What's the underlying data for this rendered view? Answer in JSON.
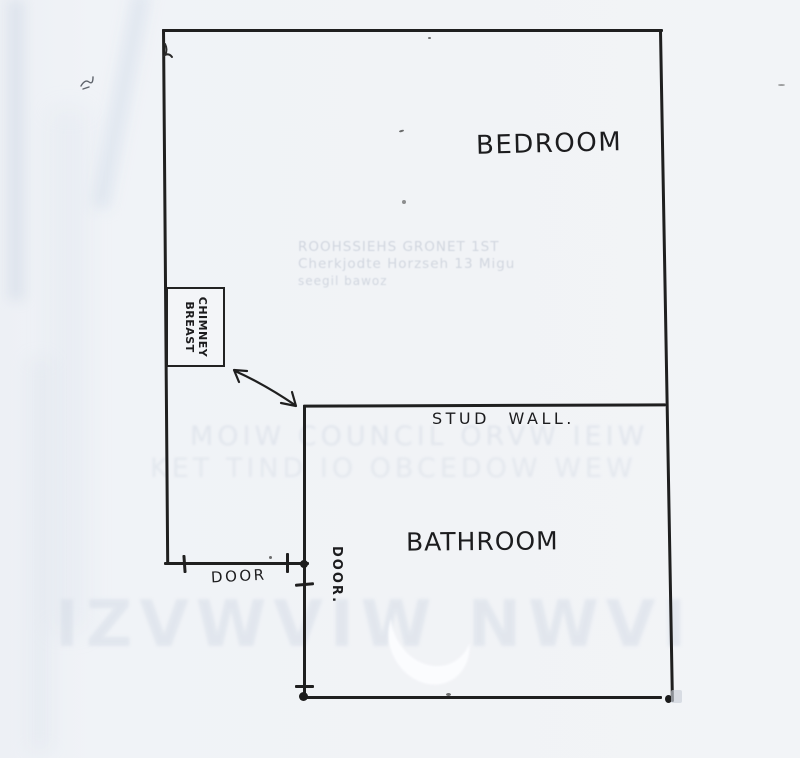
{
  "page": {
    "type": "scanned hand-drawn floor plan",
    "paper_color": "#f1f3f6",
    "ink_color": "#1f1f1f"
  },
  "plan": {
    "labels": {
      "bedroom": "BEDROOM",
      "bathroom": "BATHROOM",
      "stud_wall": "STUD WALL.",
      "chimney_line1": "CHIMNEY",
      "chimney_line2": "BREAST",
      "door_horizontal": "DOOR",
      "door_vertical": "DOOR."
    }
  },
  "bleed_through": {
    "block_a": {
      "line1": "ROOHSSIEHS GRONET 1ST",
      "line2": "Cherkjodte Horzseh 13 Migu",
      "line3": "seegil bawoz"
    },
    "band_b": {
      "line1": "MOIW COUNCIL ORVW IEIW",
      "line2": "KET TIND IO OBCEDOW WEW"
    },
    "band_c": {
      "line1": "IZVWVIW NWVI"
    }
  }
}
